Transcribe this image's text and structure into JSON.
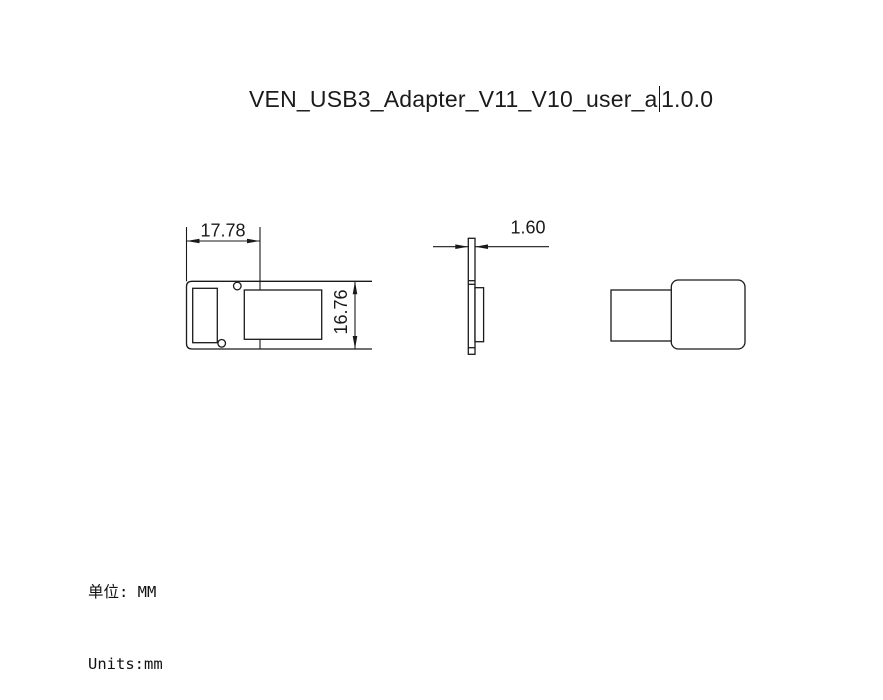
{
  "title": {
    "text_before_caret": "VEN_USB3_Adapter_V11_V10_user_a",
    "text_after_caret": "1.0.0"
  },
  "dimensions": {
    "width_label": "17.78",
    "height_label": "16.76",
    "thickness_label": "1.60"
  },
  "units": {
    "line1": "单位: MM",
    "line2": "Units:mm"
  },
  "colors": {
    "line_color": "#1a1a1a",
    "background": "#ffffff",
    "text_color": "#1b1b1b"
  }
}
